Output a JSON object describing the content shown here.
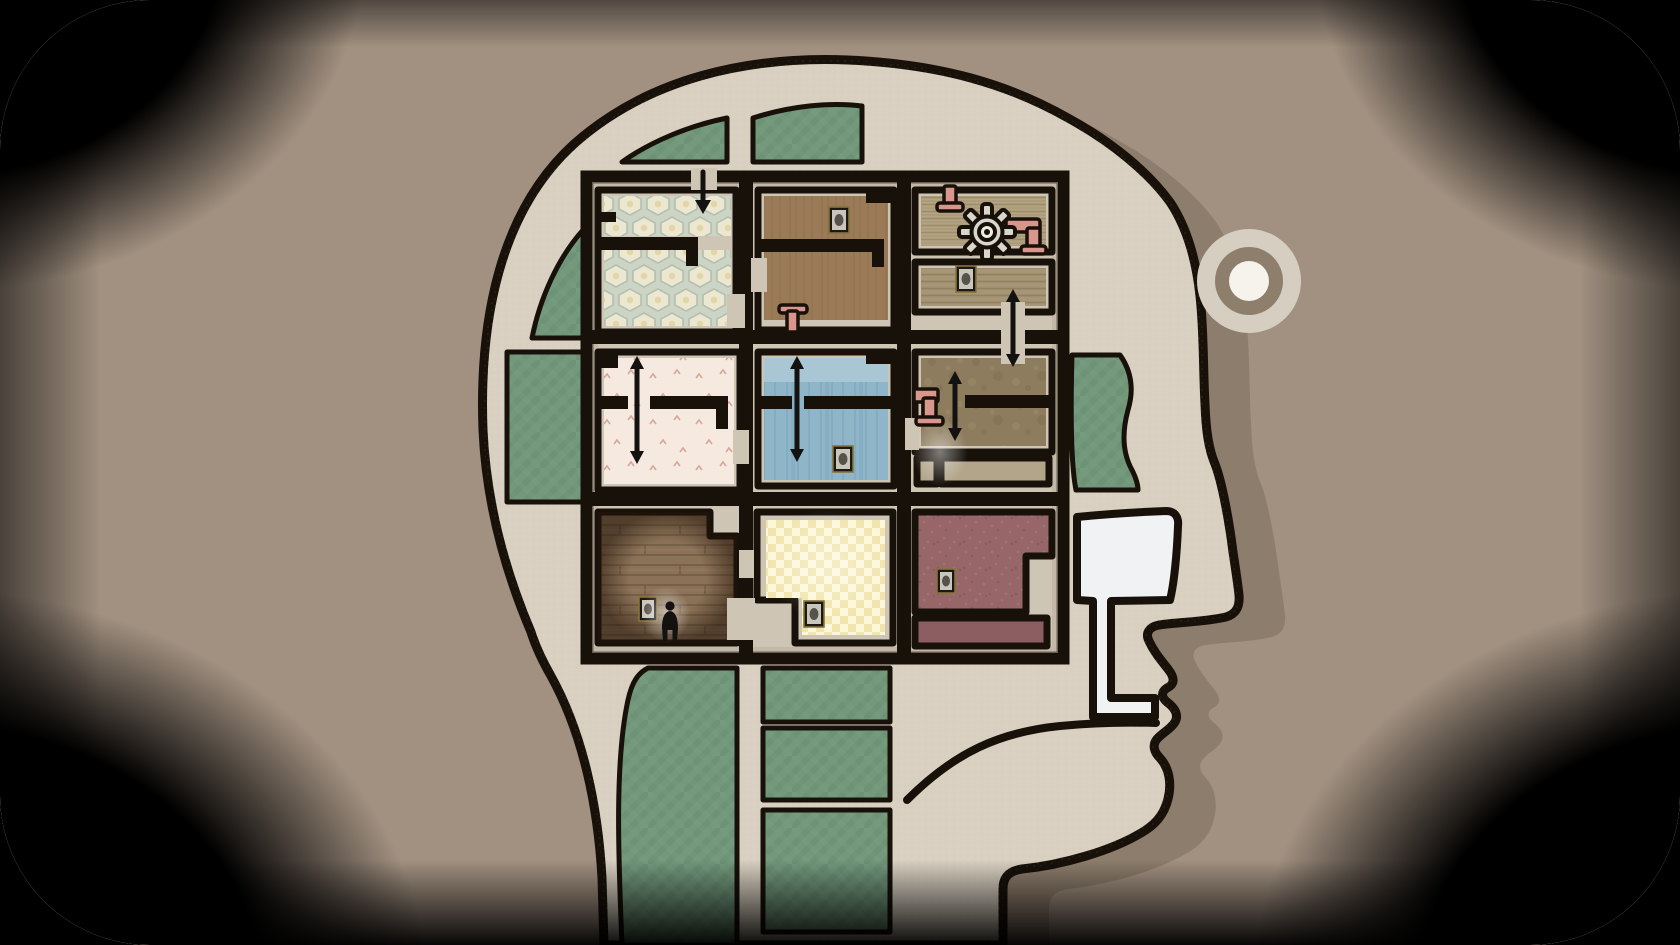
{
  "colors": {
    "background": "#a29181",
    "head_fill": "#d9d0c1",
    "head_shadow": "#8d7d6c",
    "outline": "#17110a",
    "corridor": "#cfc5b5",
    "corridor_shade": "#b9ae9e",
    "green_base": "#73987b",
    "green_line": "#668b6f",
    "hex_base": "#ccd4c5",
    "hex_cell": "#ece7d0",
    "hex_dot": "#e4d5a4",
    "brown_base": "#9b7b57",
    "slat_base": "#b3a485",
    "slat2_base": "#a69678",
    "pink_base": "#f6e9e0",
    "pink_sprig": "#cf9d8e",
    "blue_band": "#a9c6d5",
    "blue_base": "#8fb5c9",
    "olive_base": "#8d7c5d",
    "strip_base": "#b2a58a",
    "wood_base": "#8b7157",
    "check_a": "#fdf7da",
    "check_b": "#f1e5ae",
    "mauve_base": "#966669",
    "mauve_dark": "#8c5e61",
    "pipe": "#d8968c",
    "white_shape": "#f1f2f4",
    "ring_outer": "#d6cec1",
    "ring_mid": "#8e7f6c",
    "ring_inner": "#f6f3ec",
    "arrow": "#141210",
    "frame_outer": "#85743c",
    "frame_fill": "#1d1812",
    "canvas": "#c9c6bc",
    "portrait": "#56534b",
    "figure": "#141210"
  },
  "scene": {
    "head": {
      "label": "side-profile head containing a 3x3 grid of rooms, facing right",
      "earring": "concentric-circles ornament beside forehead",
      "nose": "white lamp-shaped nasal passage connecting to mouth"
    },
    "rooms": [
      {
        "label": "hexagon wallpaper room",
        "icons": [
          "down-arrow"
        ]
      },
      {
        "label": "brown room",
        "icons": [
          "framed-picture",
          "pipe-valve"
        ]
      },
      {
        "label": "machine room with gear",
        "icons": [
          "gear",
          "pipe-elbow",
          "pipe-valve"
        ]
      },
      {
        "label": "blinds room",
        "icons": [
          "framed-picture",
          "up-down-arrow"
        ]
      },
      {
        "label": "pink floral room",
        "icons": [
          "up-down-arrow"
        ]
      },
      {
        "label": "blue room",
        "icons": [
          "up-down-arrow",
          "framed-picture"
        ]
      },
      {
        "label": "olive room",
        "icons": [
          "pipe-elbow",
          "up-down-arrow",
          "white-glow"
        ]
      },
      {
        "label": "wooden plank room",
        "icons": [
          "framed-picture",
          "person-silhouette",
          "white-glow"
        ]
      },
      {
        "label": "yellow checkered room",
        "icons": [
          "framed-picture"
        ]
      },
      {
        "label": "maroon room",
        "icons": [
          "framed-picture"
        ]
      }
    ],
    "green_panels_count": 9,
    "arrows_count": 5,
    "framed_pictures_count": 6
  }
}
